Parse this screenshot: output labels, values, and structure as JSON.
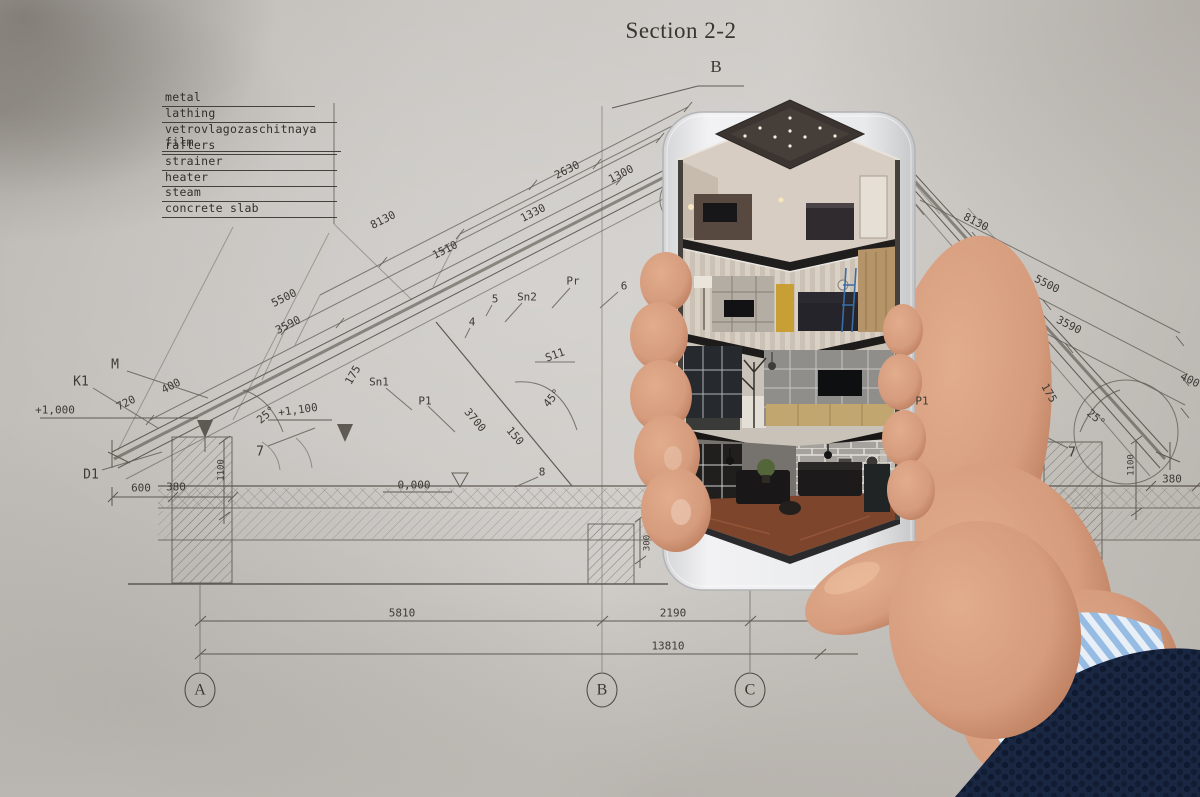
{
  "blueprint": {
    "title": "Section 2-2",
    "legend": [
      "metal",
      "lathing",
      "vetrovlagozaschitnaya film",
      "rafters",
      "strainer",
      "heater",
      "steam",
      "concrete slab"
    ],
    "axes": {
      "top": "B",
      "bottom": [
        "A",
        "B",
        "C"
      ]
    },
    "labels": [
      {
        "t": "2630"
      },
      {
        "t": "1300"
      },
      {
        "t": "8130"
      },
      {
        "t": "1330"
      },
      {
        "t": "1510"
      },
      {
        "t": "5500"
      },
      {
        "t": "3590"
      },
      {
        "t": "Pr"
      },
      {
        "t": "Sn2"
      },
      {
        "t": "5"
      },
      {
        "t": "4"
      },
      {
        "t": "6"
      },
      {
        "t": "Sn1"
      },
      {
        "t": "P1"
      },
      {
        "t": "S11"
      },
      {
        "t": "45°"
      },
      {
        "t": "3700"
      },
      {
        "t": "150"
      },
      {
        "t": "8"
      },
      {
        "t": "0,000"
      },
      {
        "t": "300"
      },
      {
        "t": "M"
      },
      {
        "t": "K1"
      },
      {
        "t": "+1,000"
      },
      {
        "t": "720"
      },
      {
        "t": "400"
      },
      {
        "t": "175"
      },
      {
        "t": "25°"
      },
      {
        "t": "+1,100"
      },
      {
        "t": "7"
      },
      {
        "t": "D1"
      },
      {
        "t": "600"
      },
      {
        "t": "380"
      },
      {
        "t": "1100"
      },
      {
        "t": "8130"
      },
      {
        "t": "5500"
      },
      {
        "t": "3590"
      },
      {
        "t": "175"
      },
      {
        "t": "25°"
      },
      {
        "t": "7"
      },
      {
        "t": "1100"
      },
      {
        "t": "380"
      },
      {
        "t": "400"
      },
      {
        "t": "P1"
      },
      {
        "t": "5810"
      },
      {
        "t": "2190"
      },
      {
        "t": "13810"
      }
    ]
  },
  "colors": {
    "paper": "#c7c4c0",
    "ink": "#4c463f",
    "phone_bezel": "#eceded",
    "skin": "#d59c7d",
    "sleeve_navy": "#1a2742",
    "cuff_blue": "#96bce4",
    "cabinet_yellow": "#c79f35",
    "floor_terracotta": "#7d452c",
    "brick_gray": "#a5a19d"
  }
}
